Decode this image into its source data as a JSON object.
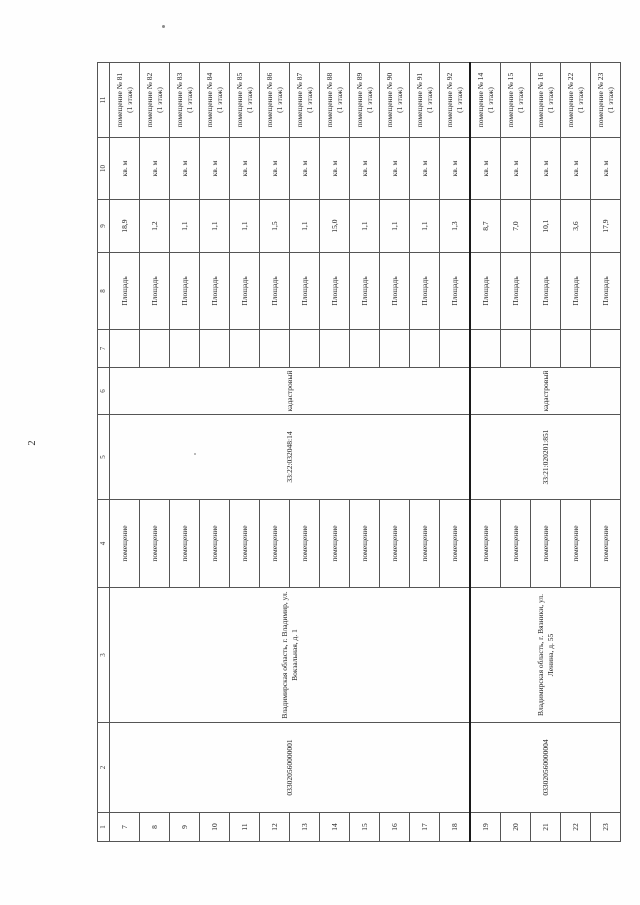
{
  "page": {
    "number": "2"
  },
  "table": {
    "column_numbers": [
      "1",
      "2",
      "3",
      "4",
      "5",
      "6",
      "7",
      "8",
      "9",
      "10",
      "11"
    ],
    "labels": {
      "object_type": "помещение",
      "number_type": "кадастровый",
      "param": "Площадь",
      "unit": "кв. м"
    },
    "groups": [
      {
        "registry_number": "033020560000001",
        "address": "Владимирская область, г. Владимир, ул. Вокзальная, д. 1",
        "cadastral_number": "33:22:032048:14",
        "rows": [
          {
            "num": "7",
            "area": "18,9",
            "name": "помещение № 81",
            "floor": "(1 этаж)"
          },
          {
            "num": "8",
            "area": "1,2",
            "name": "помещение № 82",
            "floor": "(1 этаж)"
          },
          {
            "num": "9",
            "area": "1,1",
            "name": "помещение № 83",
            "floor": "(1 этаж)"
          },
          {
            "num": "10",
            "area": "1,1",
            "name": "помещение № 84",
            "floor": "(1 этаж)"
          },
          {
            "num": "11",
            "area": "1,1",
            "name": "помещение № 85",
            "floor": "(1 этаж)"
          },
          {
            "num": "12",
            "area": "1,5",
            "name": "помещение № 86",
            "floor": "(1 этаж)"
          },
          {
            "num": "13",
            "area": "1,1",
            "name": "помещение № 87",
            "floor": "(1 этаж)"
          },
          {
            "num": "14",
            "area": "15,0",
            "name": "помещение № 88",
            "floor": "(1 этаж)"
          },
          {
            "num": "15",
            "area": "1,1",
            "name": "помещение № 89",
            "floor": "(1 этаж)"
          },
          {
            "num": "16",
            "area": "1,1",
            "name": "помещение № 90",
            "floor": "(1 этаж)"
          },
          {
            "num": "17",
            "area": "1,1",
            "name": "помещение № 91",
            "floor": "(1 этаж)"
          },
          {
            "num": "18",
            "area": "1,3",
            "name": "помещение № 92",
            "floor": "(1 этаж)"
          }
        ]
      },
      {
        "registry_number": "033020560000004",
        "address": "Владимирская область, г. Вязники, ул. Ленина, д. 55",
        "cadastral_number": "33:21:020201:851",
        "rows": [
          {
            "num": "19",
            "area": "8,7",
            "name": "помещение № 14",
            "floor": "(1 этаж)"
          },
          {
            "num": "20",
            "area": "7,0",
            "name": "помещение № 15",
            "floor": "(1 этаж)"
          },
          {
            "num": "21",
            "area": "10,1",
            "name": "помещение № 16",
            "floor": "(1 этаж)"
          },
          {
            "num": "22",
            "area": "3,6",
            "name": "помещение № 22",
            "floor": "(1 этаж)"
          },
          {
            "num": "23",
            "area": "17,9",
            "name": "помещение № 23",
            "floor": "(1 этаж)"
          }
        ]
      }
    ]
  }
}
